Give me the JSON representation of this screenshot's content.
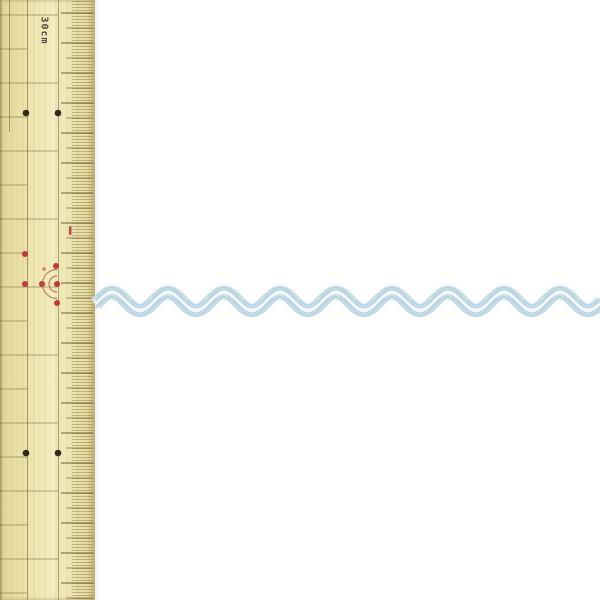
{
  "scene": {
    "description_label": "",
    "background_color": "#ffffff"
  },
  "ruler": {
    "label": "30cm",
    "label_color": "#4d4c48",
    "colors": {
      "wood": "#ece3ab",
      "wood_dark": "#e2d699",
      "wood_light": "#f3ecc1",
      "line": "#6e5f38",
      "tick": "#6e5f38",
      "black_dot": "#241b10",
      "red": "#bf2730",
      "arc": "#a8604a"
    },
    "geometry": {
      "width_px": 95,
      "mm_spacing_px": 3,
      "cm_spacing_px": 30,
      "cm_offset_px": 13,
      "tick_x_mm": 72,
      "tick_x_5mm": 66.5,
      "tick_x_cm": 61,
      "tick_x_end": 93.5,
      "vertical_lines": [
        [
          1,
          0,
          600
        ],
        [
          9.5,
          0,
          132
        ],
        [
          27.5,
          0,
          600
        ],
        [
          58.5,
          0,
          600
        ]
      ],
      "rule_start_y": 15,
      "rule_step_y": 34,
      "rule_len_long": 58,
      "rule_len_short": 27
    },
    "black_dots": [
      [
        26,
        113
      ],
      [
        58,
        113
      ],
      [
        26,
        453
      ],
      [
        58,
        453
      ]
    ],
    "red_dots": [
      [
        25,
        254
      ],
      [
        25,
        284
      ],
      [
        42,
        284
      ],
      [
        56,
        266
      ],
      [
        57,
        284
      ],
      [
        57,
        303
      ],
      [
        44,
        269
      ]
    ],
    "red_dash": [
      69,
      226,
      2.5,
      9
    ],
    "arc_center": [
      57,
      284
    ],
    "arc_radii": [
      8,
      14.5
    ]
  },
  "ribbon": {
    "kind": "ric-rac-zigzag-trim",
    "start_x": 95.5,
    "end_x": 602,
    "midline_y": 301.5,
    "amplitude": 9,
    "period": 56,
    "crest_x": 112,
    "layers": [
      {
        "offset": 0,
        "width": 13.5,
        "color": "#c6dde9",
        "opacity": 1
      },
      {
        "offset": 0,
        "width": 9,
        "color": "#dfedf4",
        "opacity": 1
      },
      {
        "offset": 0,
        "width": 4,
        "color": "#f0f7fa",
        "opacity": 1
      }
    ],
    "strand_offsets": [
      -5.2,
      -3.8,
      -2.4,
      2.4,
      3.8,
      5.2
    ],
    "strand_color": "#a9cbdc",
    "strand_width": 0.9,
    "strand_opacity": 0.8,
    "highlight_offset": -0.8,
    "highlight_color": "#ffffff",
    "highlight_width": 1.4,
    "highlight_opacity": 0.55
  }
}
